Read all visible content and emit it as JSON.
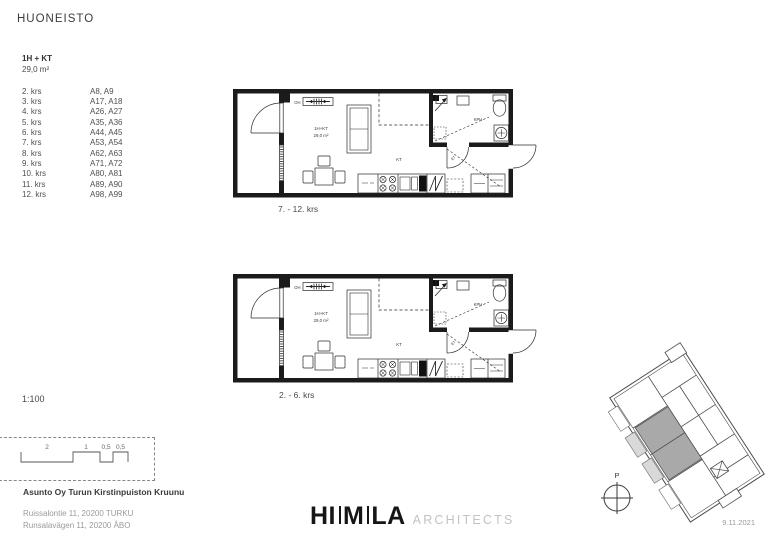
{
  "page": {
    "title": "HUONEISTO",
    "date": "9.11.2021"
  },
  "unit": {
    "type": "1H + KT",
    "area": "29,0 m²",
    "floors": [
      {
        "krs": "2. krs",
        "apts": "A8, A9"
      },
      {
        "krs": "3. krs",
        "apts": "A17, A18"
      },
      {
        "krs": "4. krs",
        "apts": "A26, A27"
      },
      {
        "krs": "5. krs",
        "apts": "A35, A36"
      },
      {
        "krs": "6. krs",
        "apts": "A44, A45"
      },
      {
        "krs": "7. krs",
        "apts": "A53, A54"
      },
      {
        "krs": "8. krs",
        "apts": "A62, A63"
      },
      {
        "krs": "9. krs",
        "apts": "A71, A72"
      },
      {
        "krs": "10. krs",
        "apts": "A80, A81"
      },
      {
        "krs": "11. krs",
        "apts": "A89, A90"
      },
      {
        "krs": "12. krs",
        "apts": "A98, A99"
      }
    ]
  },
  "plans": [
    {
      "caption": "7. - 12. krs",
      "labels": {
        "oh": "OH",
        "type": "1H+KT",
        "area": "29,0 m²",
        "kt": "KT",
        "kph": "KPH",
        "et": "ET"
      }
    },
    {
      "caption": "2. - 6. krs",
      "labels": {
        "oh": "OH",
        "type": "1H+KT",
        "area": "29,0 m²",
        "kt": "KT",
        "kph": "KPH",
        "et": "ET"
      }
    }
  ],
  "scale": {
    "label": "1:100"
  },
  "scalebar": {
    "labels": [
      "2",
      "1",
      "0,5",
      "0,5"
    ]
  },
  "project": {
    "name": "Asunto Oy Turun Kirstinpuiston Kruunu",
    "address_fi": "Ruissalontie 11, 20200 TURKU",
    "address_sv": "Runsalavägen 11, 20200 ÅBO"
  },
  "logo": {
    "p1": "HI",
    "p2": "M",
    "p3": "LA",
    "word": "ARCHITECTS"
  },
  "keyplan": {
    "north": "P"
  },
  "colors": {
    "wall": "#1b1b1b",
    "highlighted_unit": "#a9a9a9",
    "muted_text": "#9b9b9b"
  }
}
